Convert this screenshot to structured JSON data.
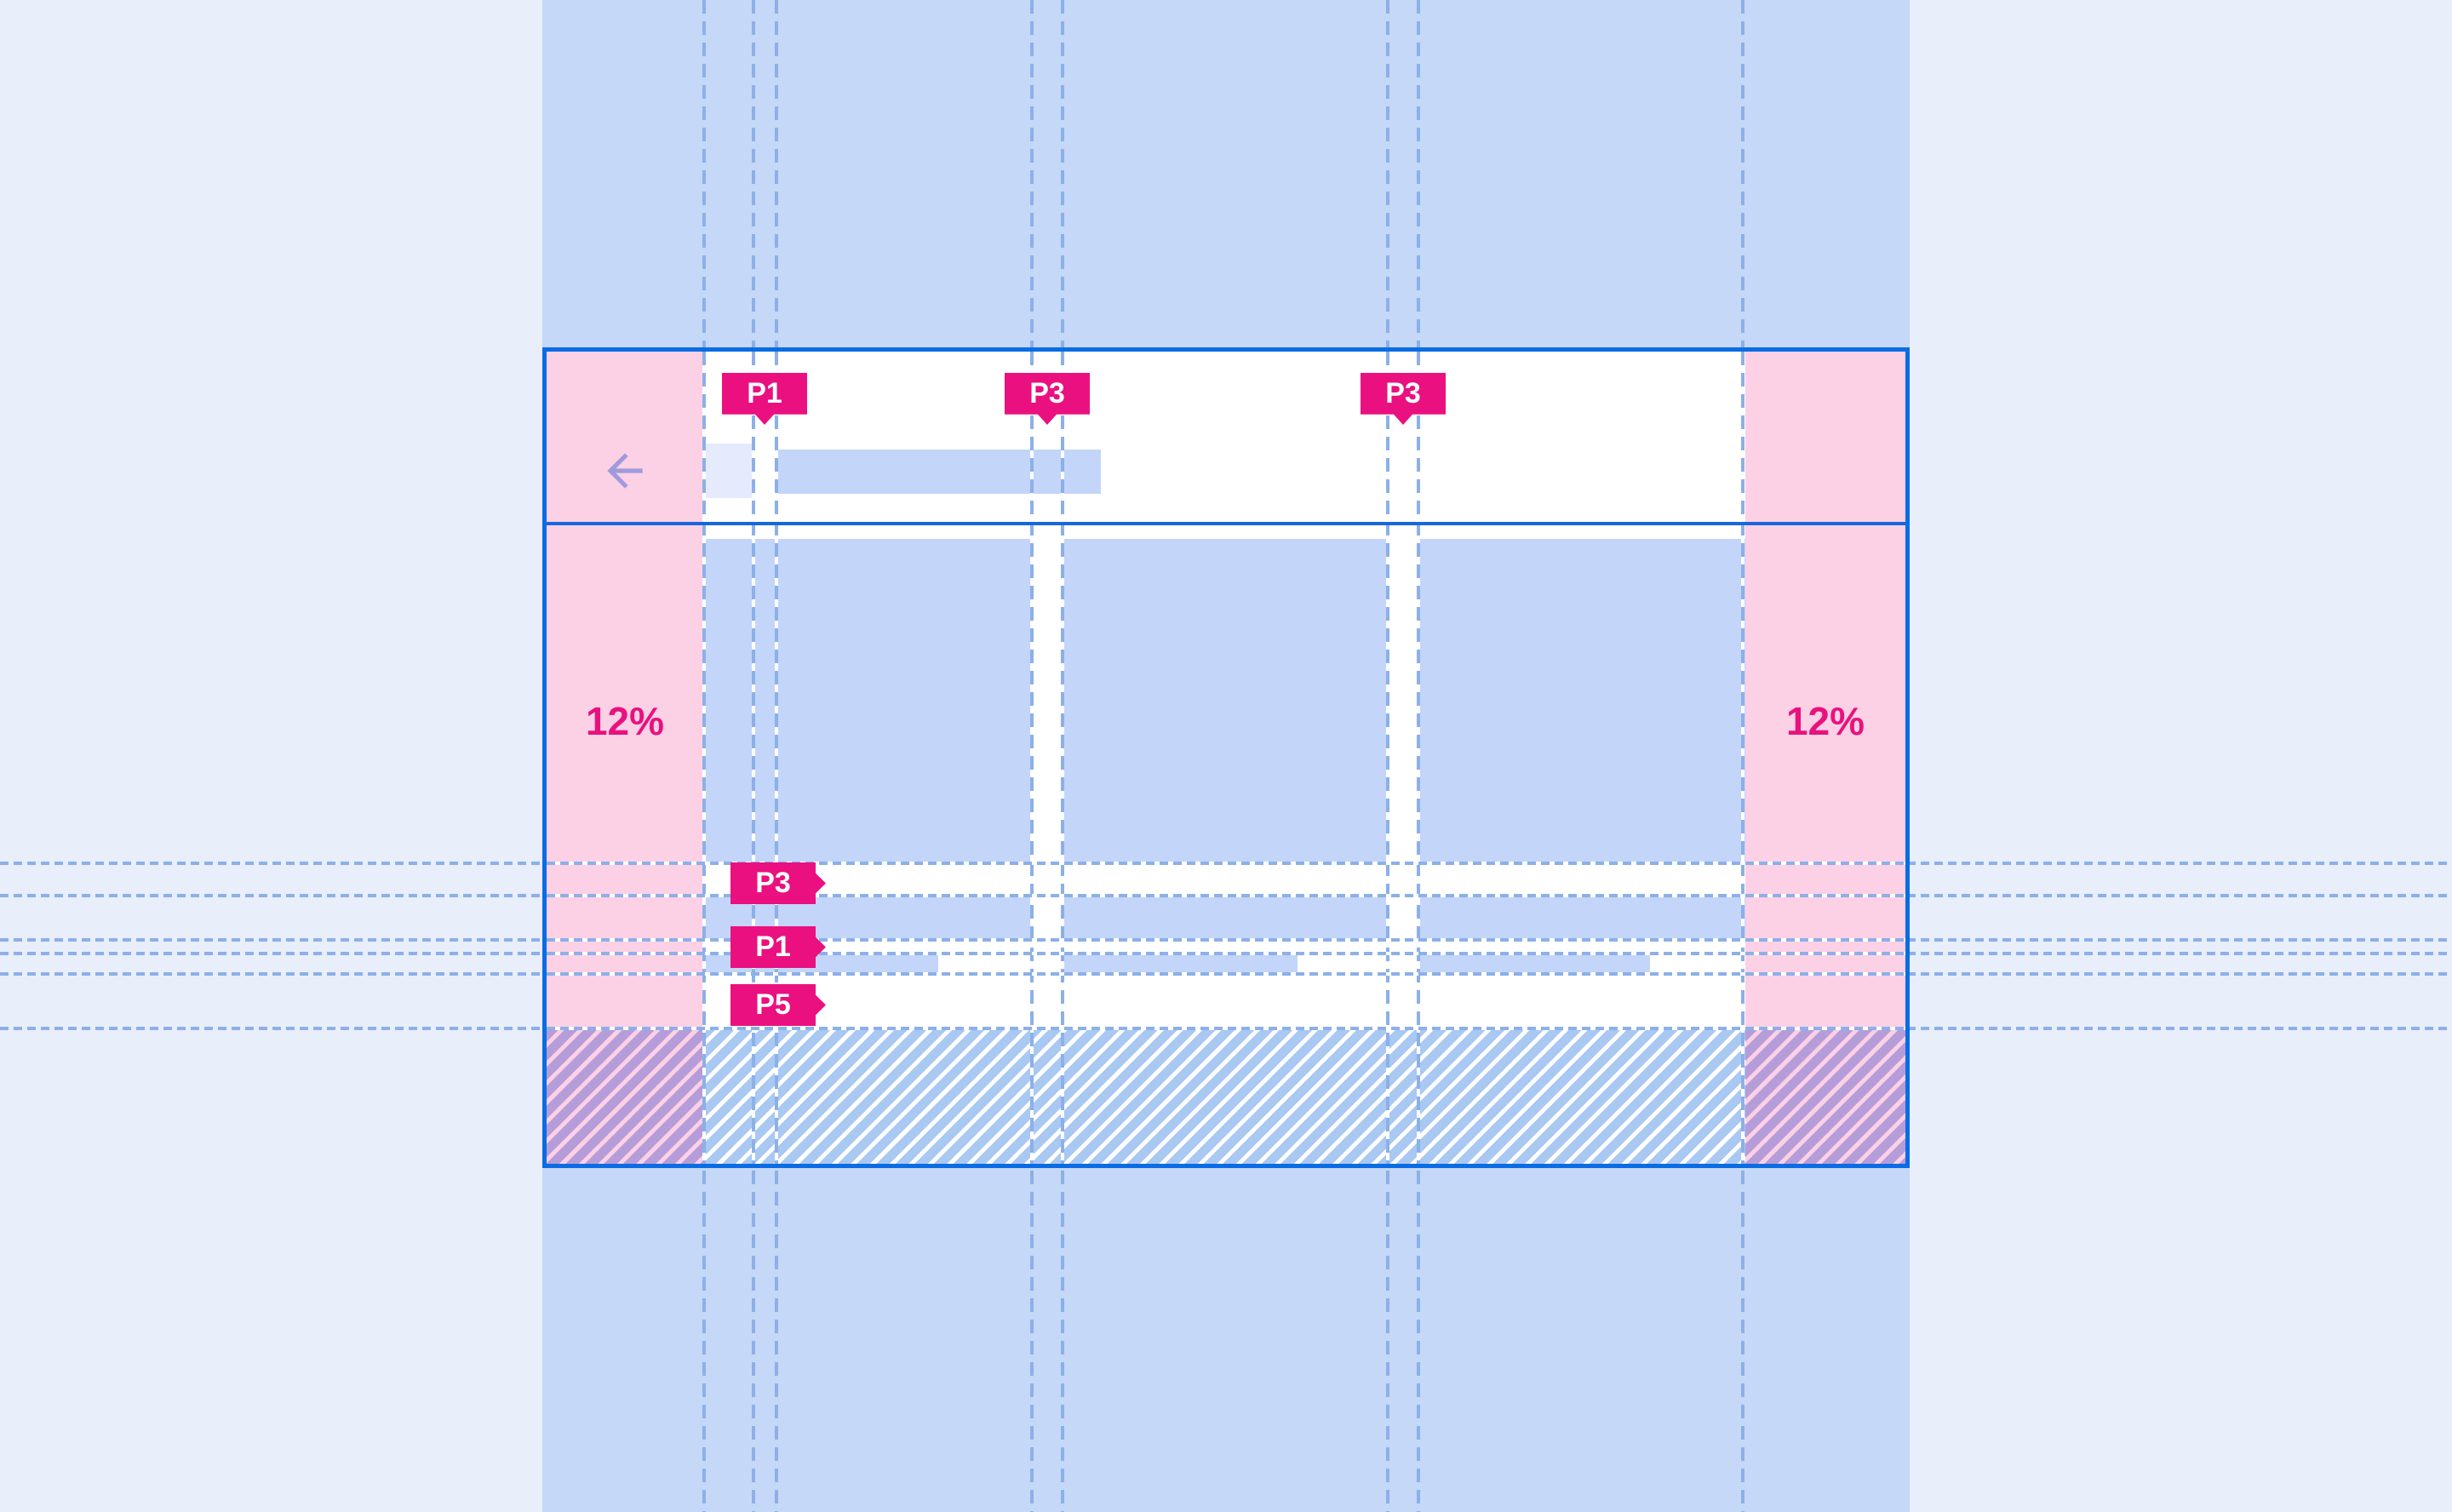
{
  "annotations": {
    "top_tags": [
      {
        "label": "P1"
      },
      {
        "label": "P3"
      },
      {
        "label": "P3"
      }
    ],
    "side_tags": [
      {
        "label": "P3"
      },
      {
        "label": "P1"
      },
      {
        "label": "P5"
      }
    ],
    "margin_left_label": "12%",
    "margin_right_label": "12%"
  },
  "icons": {
    "back_arrow": "back-arrow-icon"
  },
  "colors": {
    "page_bg": "#e9eefb",
    "band": "#c5d8f7",
    "card_bg": "#ffffff",
    "card_border": "#0b6ce4",
    "divider": "#1a66db",
    "margin_pink": "#fcd0e5",
    "placeholder_blue": "#c3d5f8",
    "icon_box": "#e5ebfc",
    "arrow": "#9f9bdb",
    "guide": "#8cb0e8",
    "tag_bg": "#ea1080",
    "tag_text": "#ffffff",
    "percent_text": "#e8127e",
    "hatch_blue": "#a9c8f2",
    "hatch_purple": "#b59dd9"
  }
}
